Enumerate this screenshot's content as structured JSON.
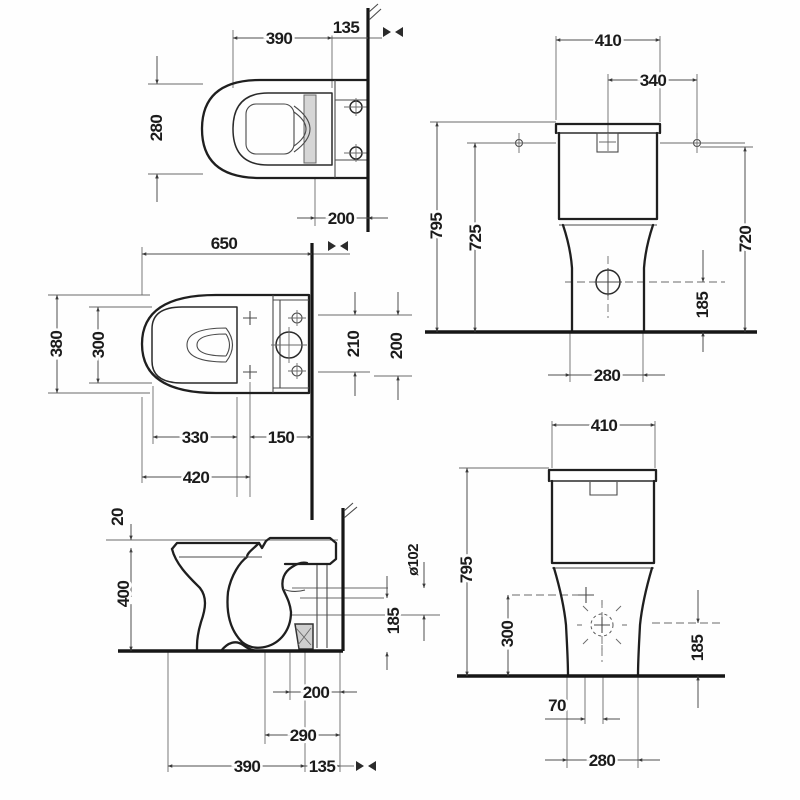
{
  "dims": {
    "top_closed": {
      "length": "390",
      "to_wall": "135",
      "width": "280",
      "hinge_wall": "200"
    },
    "top_open": {
      "depth": "650",
      "width": "380",
      "inner_width": "300",
      "span_a": "210",
      "span_b": "200",
      "inner_length": "330",
      "rear": "150",
      "front_hinge": "420"
    },
    "side": {
      "seat": "20",
      "height": "400",
      "outlet_h": "185",
      "outlet_d": "ø102",
      "drain_wall": "200",
      "fix_wall": "290",
      "front_drain": "390",
      "flange_wall": "135"
    },
    "rear": {
      "width": "410",
      "fixings": "340",
      "total_h": "795",
      "tank_h": "725",
      "right_h": "720",
      "inlet_h": "185",
      "base": "280"
    },
    "front": {
      "width": "410",
      "total_h": "795",
      "supply_h": "300",
      "inlet_h": "185",
      "drain_off": "70",
      "base": "280"
    }
  },
  "colors": {
    "line": "#1f1f1f",
    "dim": "#4d4d4d",
    "fill_gray": "#d6d6d6"
  }
}
